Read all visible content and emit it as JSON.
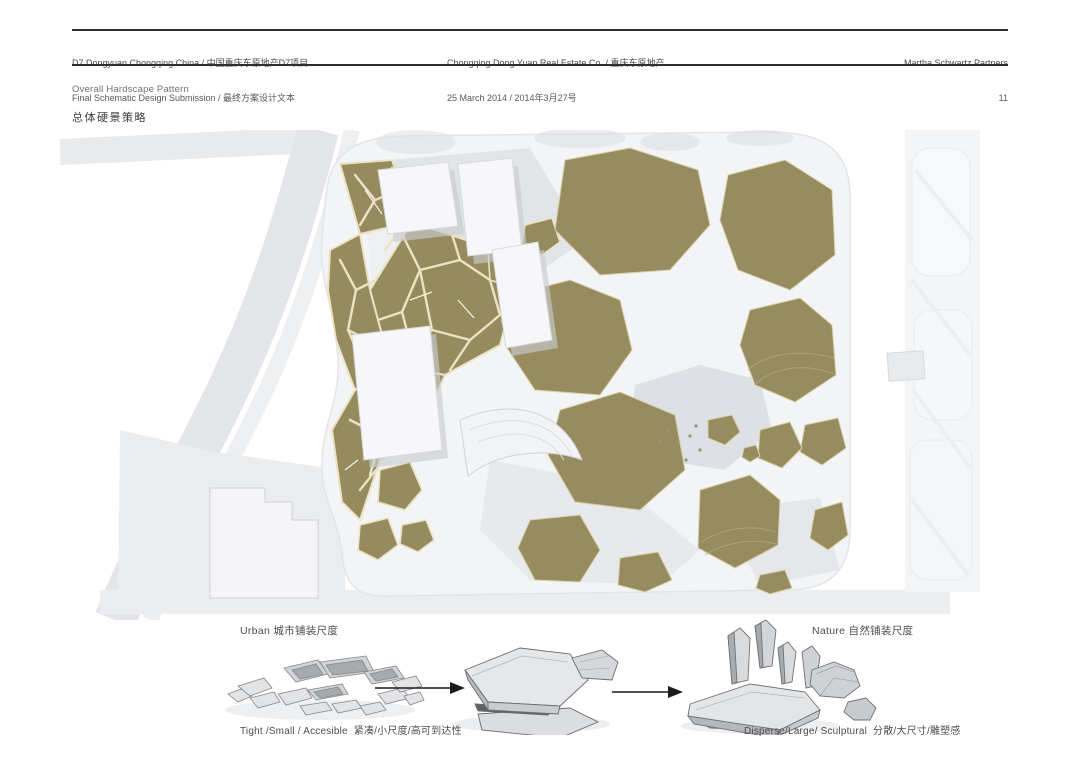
{
  "header": {
    "left": {
      "line1": "D7 Dongyuan Chongqing China / 中国重庆东原地产D7项目",
      "line2": "Final Schematic Design Submission / 最终方案设计文本"
    },
    "center": {
      "line1": "Chongqing Dong Yuan Real Estate Co. / 重庆东原地产",
      "line2": "25 March 2014 / 2014年3月27号"
    },
    "right": {
      "company": "Martha Schwartz Partners",
      "page_number": "11"
    }
  },
  "section": {
    "title_en": "Overall Hardscape Pattern",
    "title_cn": "总体硬景策略"
  },
  "plan": {
    "label_urban": "Urban 城市铺装尺度",
    "label_nature": "Nature 自然铺装尺度",
    "colors": {
      "stone": "#958b5e",
      "joint": "#ece3c4",
      "ground": "#f3f4f6",
      "road": "#e3e5e8",
      "pond": "#dde1e6",
      "building": "#f7f7f9"
    }
  },
  "diagrams": {
    "caption_tight": "Tight /Small / Accesible  紧凑/小尺度/高可到达性",
    "caption_disperse": "Disperse/Large/ Sculptural  分散/大尺寸/雕塑感"
  }
}
